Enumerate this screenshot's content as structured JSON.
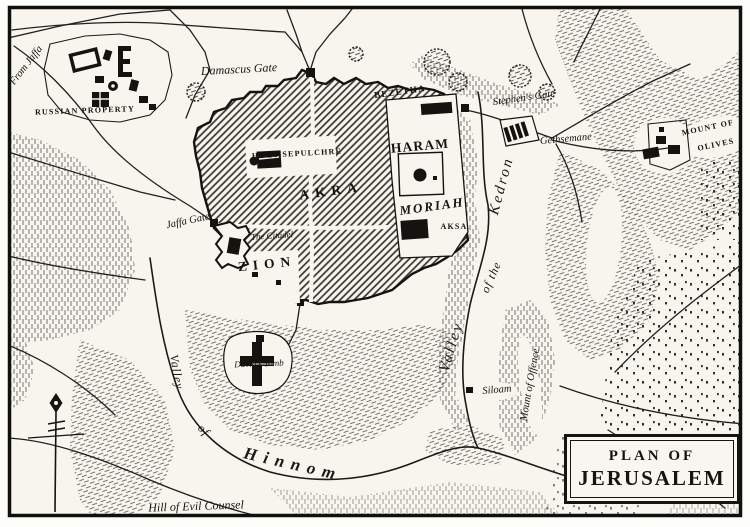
{
  "map": {
    "title_box": {
      "line1": "PLAN OF",
      "line2": "JERUSALEM"
    },
    "labels": [
      {
        "name": "label-from-jaffa",
        "text": "From Jaffa",
        "x": 27,
        "y": 66,
        "rot": -52,
        "cls": "ital sm"
      },
      {
        "name": "label-russian-property",
        "text": "RUSSIAN PROPERTY",
        "x": 85,
        "y": 111,
        "rot": -2,
        "cls": "caps xxs"
      },
      {
        "name": "label-damascus-gate",
        "text": "Damascus Gate",
        "x": 239,
        "y": 69,
        "rot": -3,
        "cls": "ital md"
      },
      {
        "name": "label-bezetha",
        "text": "BEZETHA",
        "x": 400,
        "y": 92,
        "rot": -8,
        "cls": "caps xs"
      },
      {
        "name": "label-stephens-gate",
        "text": "Stephen's Gate",
        "x": 524,
        "y": 99,
        "rot": -8,
        "cls": "ital sm"
      },
      {
        "name": "label-gethsemane",
        "text": "Gethsemane",
        "x": 566,
        "y": 140,
        "rot": -5,
        "cls": "ital sm"
      },
      {
        "name": "label-mount-of-olives-1",
        "text": "MOUNT OF",
        "x": 708,
        "y": 128,
        "rot": -12,
        "cls": "caps xxs"
      },
      {
        "name": "label-mount-of-olives-2",
        "text": "OLIVES",
        "x": 716,
        "y": 145,
        "rot": -12,
        "cls": "caps xxs"
      },
      {
        "name": "label-holy-sepulchre",
        "text": "HOLY SEPULCHRE",
        "x": 297,
        "y": 154,
        "rot": -3,
        "cls": "caps xxs"
      },
      {
        "name": "label-haram",
        "text": "HARAM",
        "x": 420,
        "y": 146,
        "rot": -5,
        "cls": "caps lg"
      },
      {
        "name": "label-akra",
        "text": "AKRA",
        "x": 331,
        "y": 191,
        "rot": -8,
        "cls": "caps lg sp"
      },
      {
        "name": "label-moriah",
        "text": "MORIAH",
        "x": 432,
        "y": 206,
        "rot": -8,
        "cls": "italcaps"
      },
      {
        "name": "label-el-aksa",
        "text": "AKSA",
        "x": 454,
        "y": 227,
        "rot": 0,
        "cls": "caps xxs"
      },
      {
        "name": "label-jaffa-gate",
        "text": "Jaffa Gate",
        "x": 188,
        "y": 222,
        "rot": -12,
        "cls": "ital sm"
      },
      {
        "name": "label-the-citadel",
        "text": "The Citadel",
        "x": 272,
        "y": 236,
        "rot": -4,
        "cls": "ital xs"
      },
      {
        "name": "label-zion",
        "text": "ZION",
        "x": 267,
        "y": 264,
        "rot": -6,
        "cls": "caps lg sp"
      },
      {
        "name": "label-davids-tomb",
        "text": "David's Tomb",
        "x": 259,
        "y": 364,
        "rot": -2,
        "cls": "ital xs"
      },
      {
        "name": "label-siloam",
        "text": "Siloam",
        "x": 497,
        "y": 391,
        "rot": -5,
        "cls": "ital sm"
      },
      {
        "name": "label-mount-of-offence",
        "text": "Mount of Offence",
        "x": 531,
        "y": 385,
        "rot": -80,
        "cls": "ital sm"
      },
      {
        "name": "label-kedron-valley-1",
        "text": "Valley",
        "x": 452,
        "y": 347,
        "rot": -73,
        "cls": "valley lg"
      },
      {
        "name": "label-kedron-valley-2",
        "text": "of the",
        "x": 491,
        "y": 277,
        "rot": -66,
        "cls": "valley md"
      },
      {
        "name": "label-kedron-valley-3",
        "text": "Kedron",
        "x": 502,
        "y": 186,
        "rot": -75,
        "cls": "valley lg"
      },
      {
        "name": "label-hinnom-valley-1",
        "text": "Valley",
        "x": 177,
        "y": 372,
        "rot": 80,
        "cls": "valley md"
      },
      {
        "name": "label-hinnom-valley-2",
        "text": "of",
        "x": 204,
        "y": 430,
        "rot": 45,
        "cls": "valley md"
      },
      {
        "name": "label-hinnom-valley-3",
        "text": "Hinnom",
        "x": 293,
        "y": 464,
        "rot": 13,
        "cls": "valley xl"
      },
      {
        "name": "label-hill-evil-counsel",
        "text": "Hill of Evil Counsel",
        "x": 196,
        "y": 506,
        "rot": -2,
        "cls": "ital md"
      }
    ]
  },
  "colors": {
    "ink": "#1c1b17",
    "paper": "#f7f5ee"
  }
}
